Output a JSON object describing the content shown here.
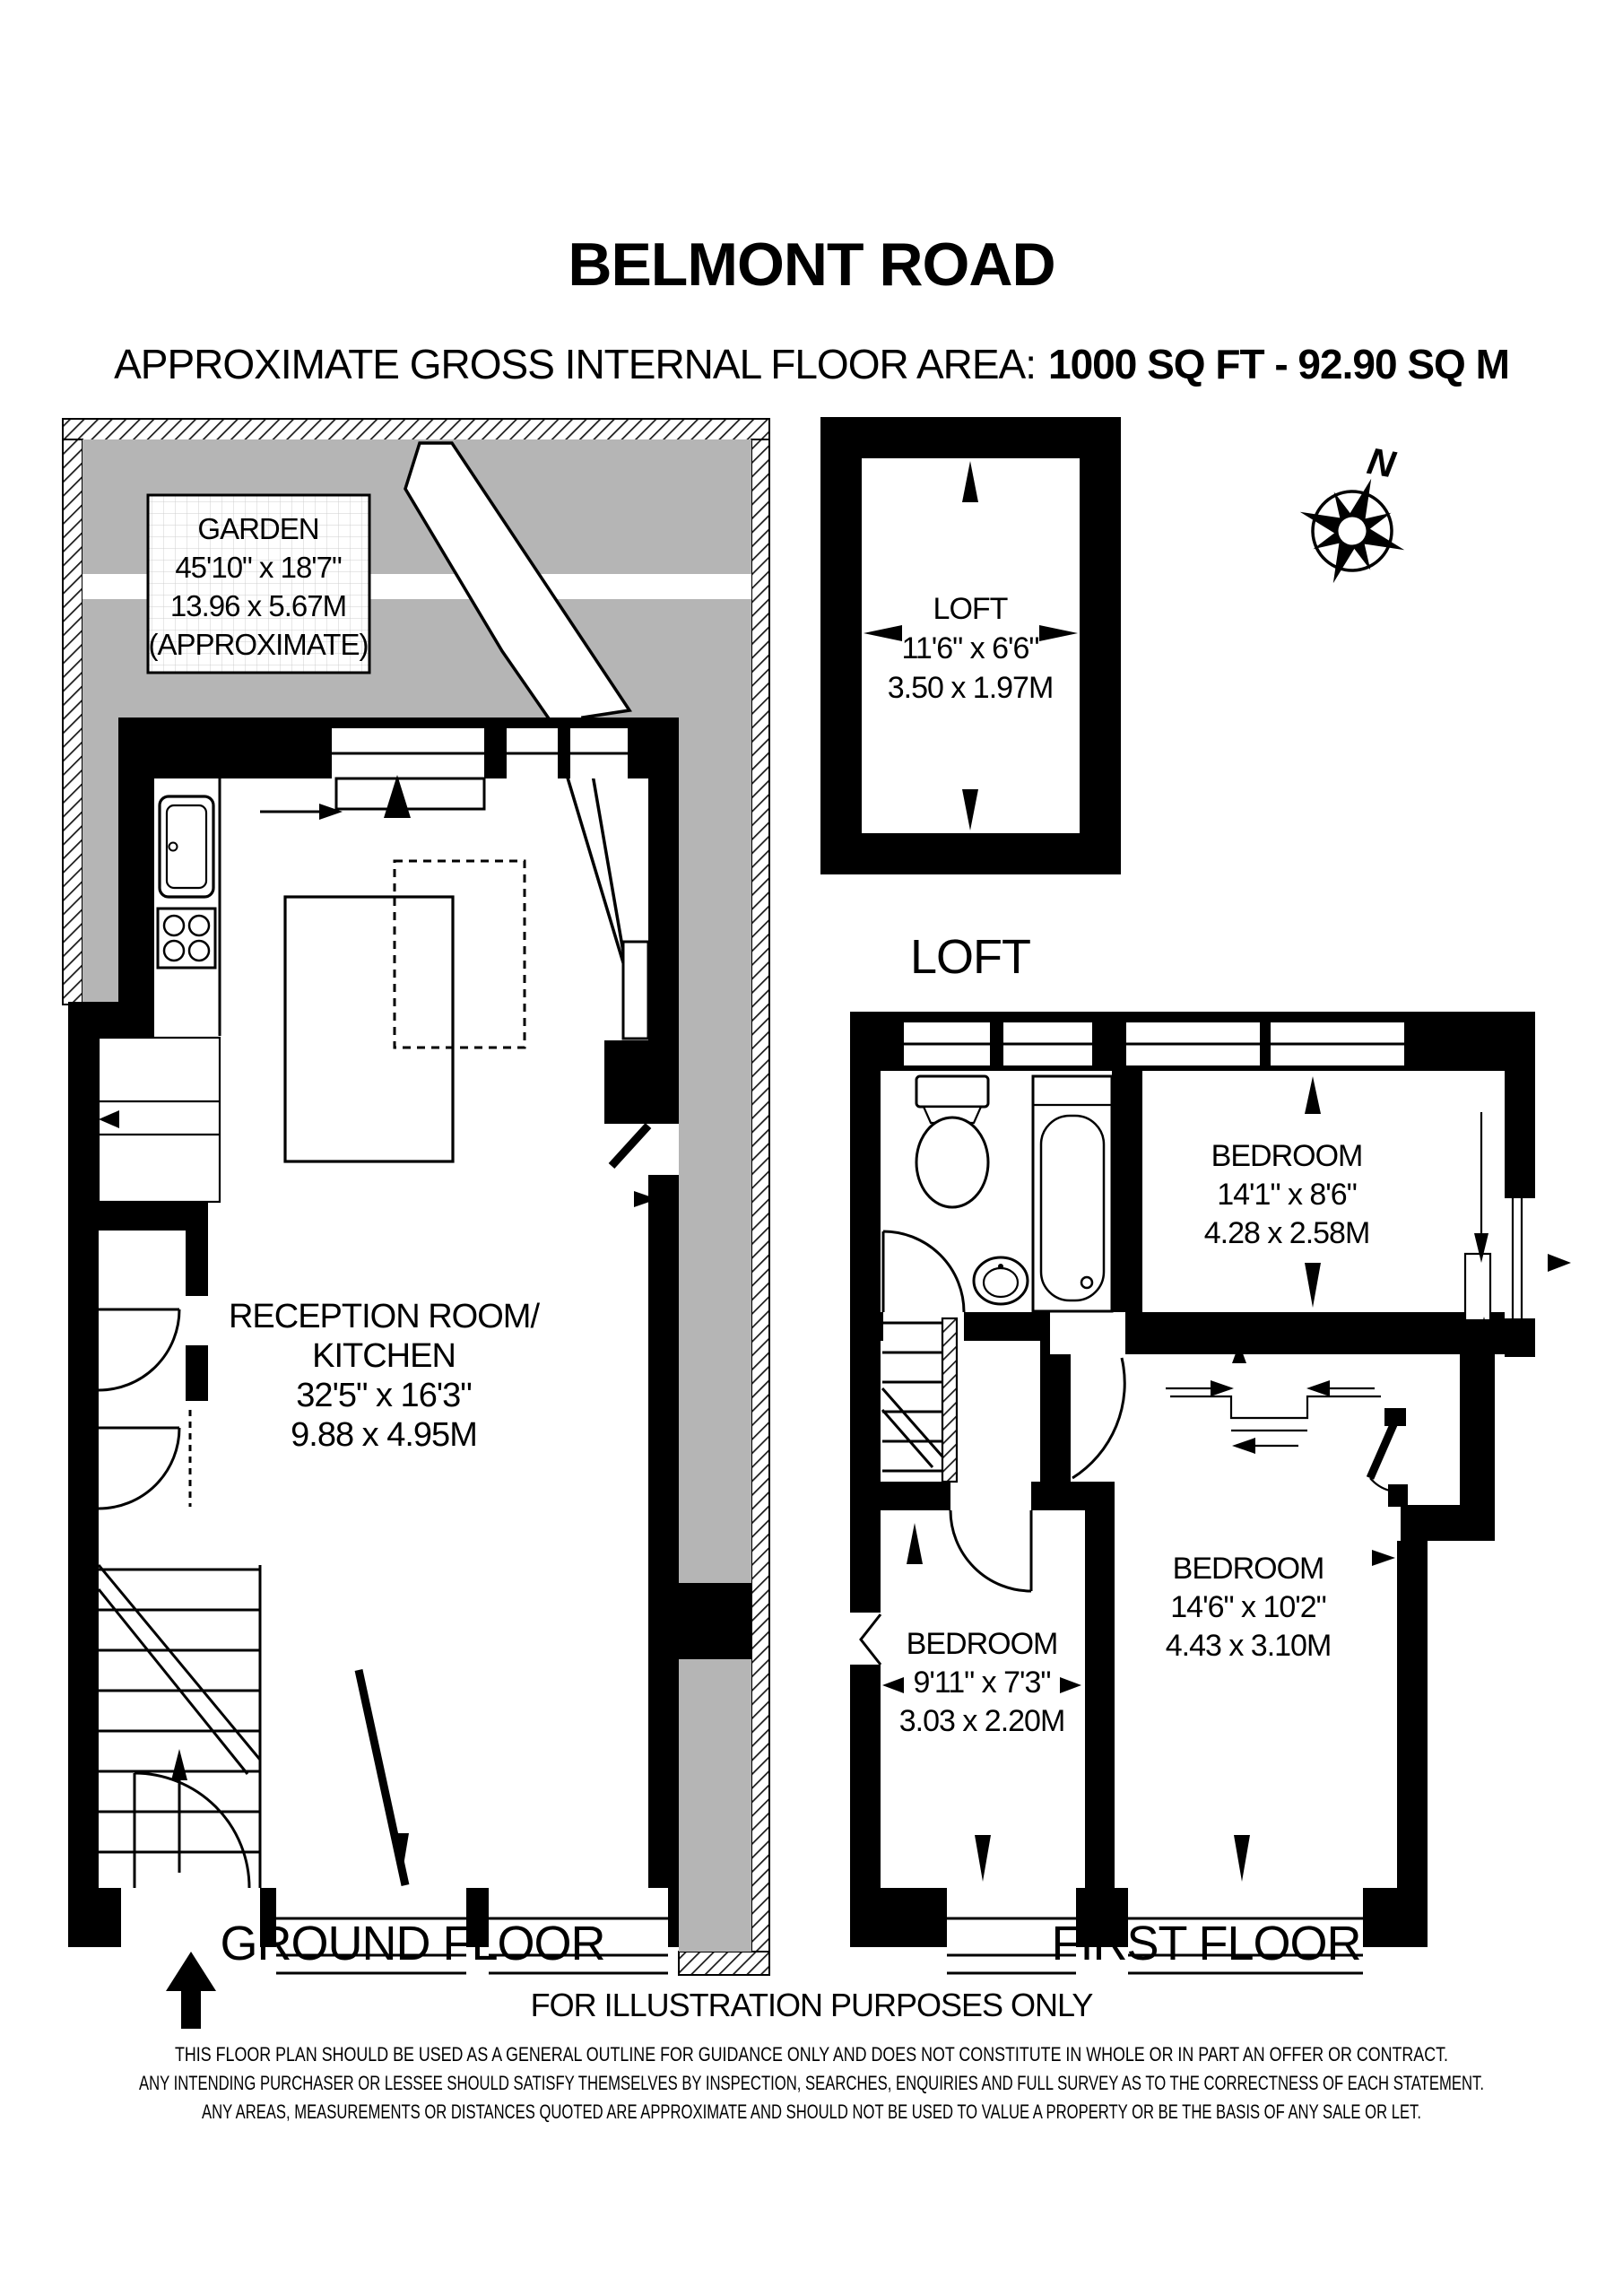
{
  "title": "BELMONT ROAD",
  "subtitle": {
    "prefix": "APPROXIMATE GROSS INTERNAL FLOOR AREA:",
    "value": "1000 SQ FT  -  92.90 SQ M"
  },
  "compass": {
    "north_label": "N"
  },
  "garden": {
    "name": "GARDEN",
    "dimensions_ft": "45'10\" x 18'7\"",
    "dimensions_m": "13.96 x 5.67M",
    "note": "(APPROXIMATE)"
  },
  "rooms": {
    "loft": {
      "name": "LOFT",
      "dimensions_ft": "11'6\" x 6'6\"",
      "dimensions_m": "3.50 x 1.97M"
    },
    "reception": {
      "name_line1": "RECEPTION ROOM/",
      "name_line2": "KITCHEN",
      "dimensions_ft": "32'5\" x 16'3\"",
      "dimensions_m": "9.88 x 4.95M"
    },
    "bedroom_top": {
      "name": "BEDROOM",
      "dimensions_ft": "14'1\" x 8'6\"",
      "dimensions_m": "4.28 x 2.58M"
    },
    "bedroom_middle": {
      "name": "BEDROOM",
      "dimensions_ft": "14'6\" x 10'2\"",
      "dimensions_m": "4.43 x 3.10M"
    },
    "bedroom_small": {
      "name": "BEDROOM",
      "dimensions_ft": "9'11\" x 7'3\"",
      "dimensions_m": "3.03 x 2.20M"
    }
  },
  "floor_labels": {
    "ground": "GROUND FLOOR",
    "first": "FIRST FLOOR",
    "loft": "LOFT"
  },
  "footer": {
    "illustration_note": "FOR ILLUSTRATION PURPOSES ONLY",
    "disclaimer": [
      "THIS FLOOR PLAN SHOULD BE USED AS A GENERAL OUTLINE FOR GUIDANCE ONLY AND DOES NOT CONSTITUTE IN WHOLE OR IN PART AN OFFER OR CONTRACT.",
      "ANY INTENDING PURCHASER OR LESSEE SHOULD SATISFY THEMSELVES BY INSPECTION, SEARCHES, ENQUIRIES AND FULL SURVEY AS TO THE CORRECTNESS OF EACH STATEMENT.",
      "ANY AREAS, MEASUREMENTS OR DISTANCES QUOTED ARE APPROXIMATE AND SHOULD NOT BE USED TO VALUE A PROPERTY OR BE THE BASIS OF ANY SALE OR LET."
    ]
  },
  "colors": {
    "wall": "#000000",
    "garden_gray": "#b5b5b5",
    "background": "#ffffff"
  }
}
